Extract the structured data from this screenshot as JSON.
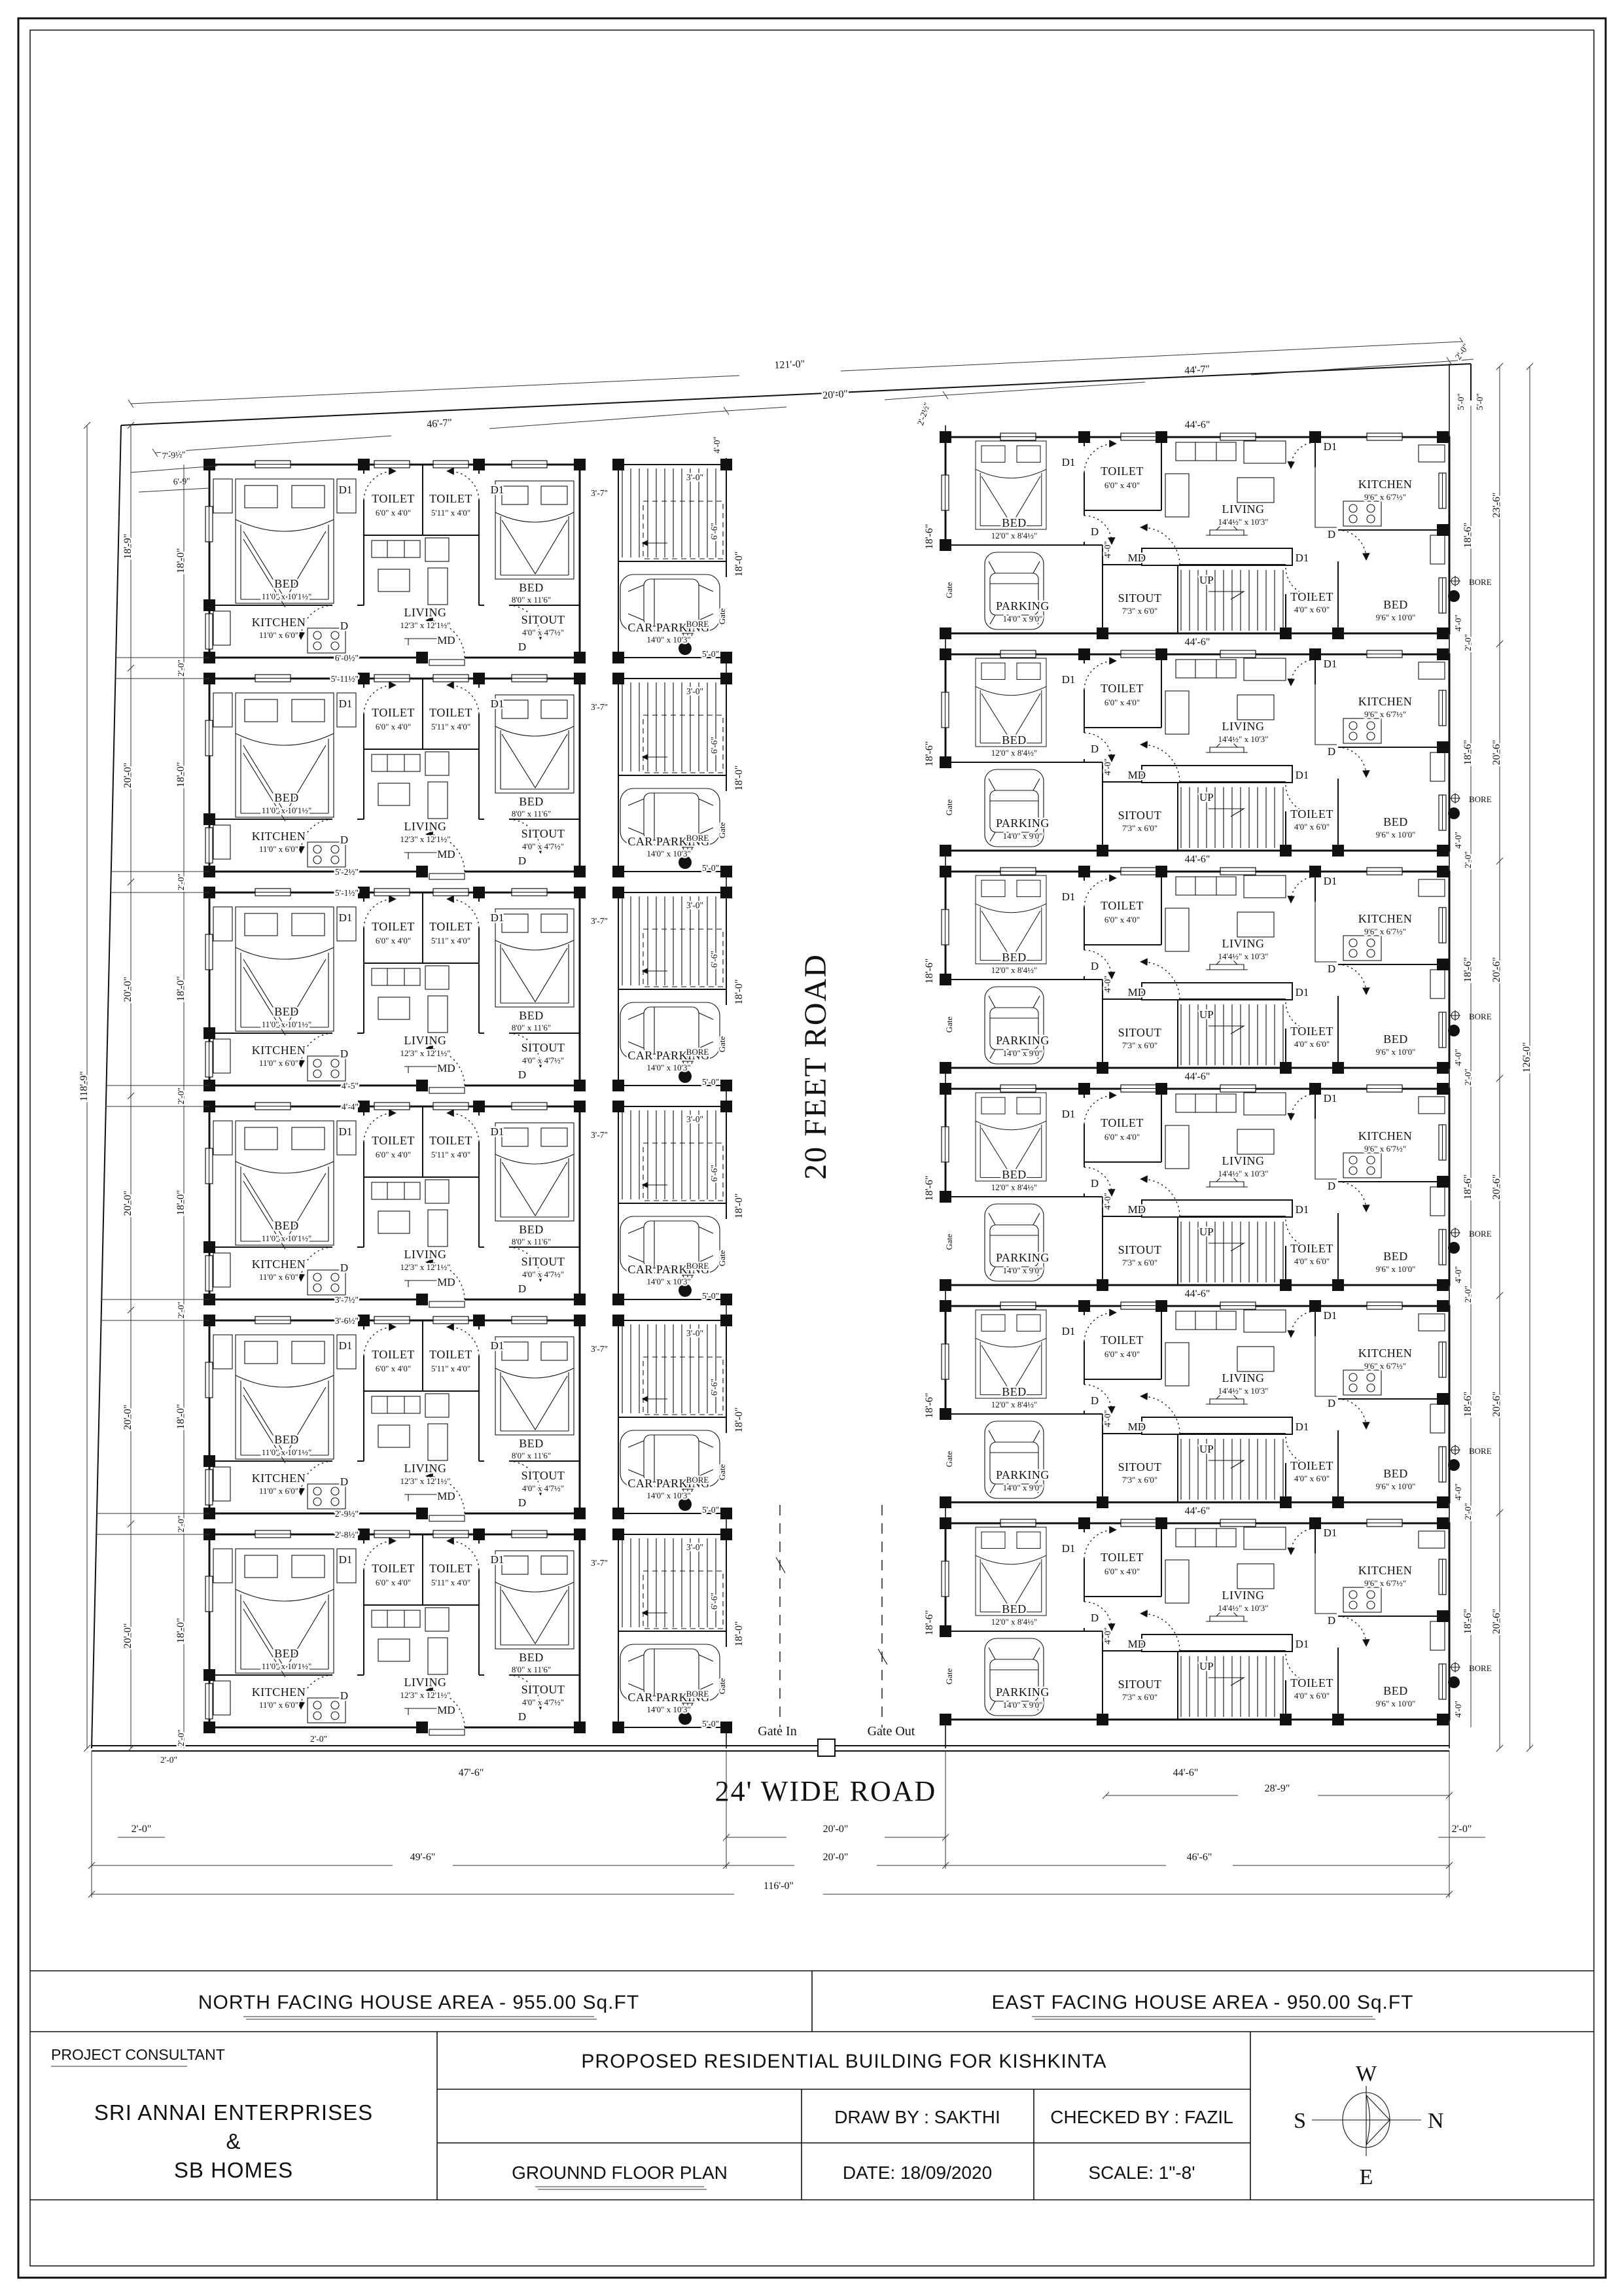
{
  "roads": {
    "center": "20 FEET ROAD",
    "bottom": "24' WIDE ROAD",
    "gate_in": "Gate In",
    "gate_out": "Gate Out"
  },
  "top_dims": {
    "overall": "121'-0\"",
    "left_block": "46'-7\"",
    "center": "20'-0\"",
    "right_block": "44'-7\"",
    "corner": "2'-0\"",
    "left_a": "7'-9½\"",
    "left_b": "6'-9\"",
    "right_slant": "2'-2½\"",
    "right_a": "5'-0\"",
    "right_b": "5'-0\"",
    "entry": "4'-0\""
  },
  "left_dims": {
    "total": "118'-9\"",
    "col1": [
      "18'-9\"",
      "20'-0\"",
      "20'-0\"",
      "20'-0\"",
      "20'-0\"",
      "20'-0\""
    ],
    "unit": "18'-0\"",
    "gap": "2'-0\"",
    "slant": [
      [
        "6'-0½\"",
        "5'-11½\""
      ],
      [
        "5'-2½\"",
        "5'-1½\""
      ],
      [
        "4'-5\"",
        "4'-4\""
      ],
      [
        "3'-7½\"",
        "3'-6½\""
      ],
      [
        "2'-9½\"",
        "2'-8½\""
      ]
    ],
    "bottom": "2'-0\""
  },
  "right_dims": {
    "total": "126'-0\"",
    "col1": [
      "23'-6\"",
      "20'-6\"",
      "20'-6\"",
      "20'-6\"",
      "20'-6\"",
      "20'-6\""
    ],
    "unit": "18'-6\"",
    "gap": "2'-0\""
  },
  "bottom_dims": {
    "r1_left": "2'-0\"",
    "r1_mid": "20'-0\"",
    "r1_right": "2'-0\"",
    "r2_left": "49'-6\"",
    "r2_mid": "20'-0\"",
    "r2_right": "46'-6\"",
    "total": "116'-0\"",
    "left_block": "47'-6\"",
    "right_block": "44'-6\"",
    "right_sub": "28'-9\"",
    "corner_left": "2'-0\""
  },
  "left_unit": {
    "bed1": {
      "name": "BED",
      "size": "11'0\" x 10'1½\""
    },
    "toilet1": {
      "name": "TOILET",
      "size": "6'0\" x 4'0\""
    },
    "toilet2": {
      "name": "TOILET",
      "size": "5'11\" x 4'0\""
    },
    "bed2": {
      "name": "BED",
      "size": "8'0\" x 11'6\""
    },
    "living": {
      "name": "LIVING",
      "size": "12'3\" x 12'1½\""
    },
    "kitchen": {
      "name": "KITCHEN",
      "size": "11'0\" x 6'0\""
    },
    "sitout": {
      "name": "SITOUT",
      "size": "4'0\" x 4'7½\""
    },
    "parking": {
      "name": "CAR PARKING",
      "size": "14'0\" x 10'3\""
    },
    "bore": "BORE",
    "gate": "Gate",
    "d1": "D1",
    "d": "D",
    "md": "MD",
    "dim_unit_h": "18'-0\"",
    "dim_stair_w": "3'-0\"",
    "dim_stair_h": "6'-6\"",
    "dim_passage": "3'-7\"",
    "dim_bore": "5'-0\""
  },
  "right_unit": {
    "bed1": {
      "name": "BED",
      "size": "12'0\" x 8'4½\""
    },
    "toilet1": {
      "name": "TOILET",
      "size": "6'0\" x 4'0\""
    },
    "living": {
      "name": "LIVING",
      "size": "14'4½\" x 10'3\""
    },
    "kitchen": {
      "name": "KITCHEN",
      "size": "9'6\" x 6'7½\""
    },
    "parking": {
      "name": "PARKING",
      "size": "14'0\" x 9'0\""
    },
    "sitout": {
      "name": "SITOUT",
      "size": "7'3\" x 6'0\""
    },
    "toilet2": {
      "name": "TOILET",
      "size": "4'0\" x 6'0\""
    },
    "bed2": {
      "name": "BED",
      "size": "9'6\" x 10'0\""
    },
    "up": "UP",
    "bore": "BORE",
    "gate": "Gate",
    "d1": "D1",
    "d": "D",
    "md": "MD",
    "dim_top": "44'-6\"",
    "dim_unit_h": "18'-6\"",
    "dim_hall": "4'-0\"",
    "dim_bore": "4'-0\""
  },
  "area_row": {
    "north": "NORTH FACING HOUSE AREA - 955.00 Sq.FT",
    "east": "EAST FACING HOUSE AREA - 950.00 Sq.FT"
  },
  "title_block": {
    "consultant_label": "PROJECT CONSULTANT",
    "consultant1": "SRI ANNAI ENTERPRISES",
    "consultant_amp": "&",
    "consultant2": "SB HOMES",
    "project": "PROPOSED RESIDENTIAL BUILDING FOR KISHKINTA",
    "drawn": "DRAW BY : SAKTHI",
    "checked": "CHECKED BY : FAZIL",
    "drawing": "GROUNND FLOOR PLAN",
    "date": "DATE: 18/09/2020",
    "scale": "SCALE: 1\"-8'",
    "compass": {
      "n": "N",
      "s": "S",
      "e": "E",
      "w": "W"
    }
  }
}
